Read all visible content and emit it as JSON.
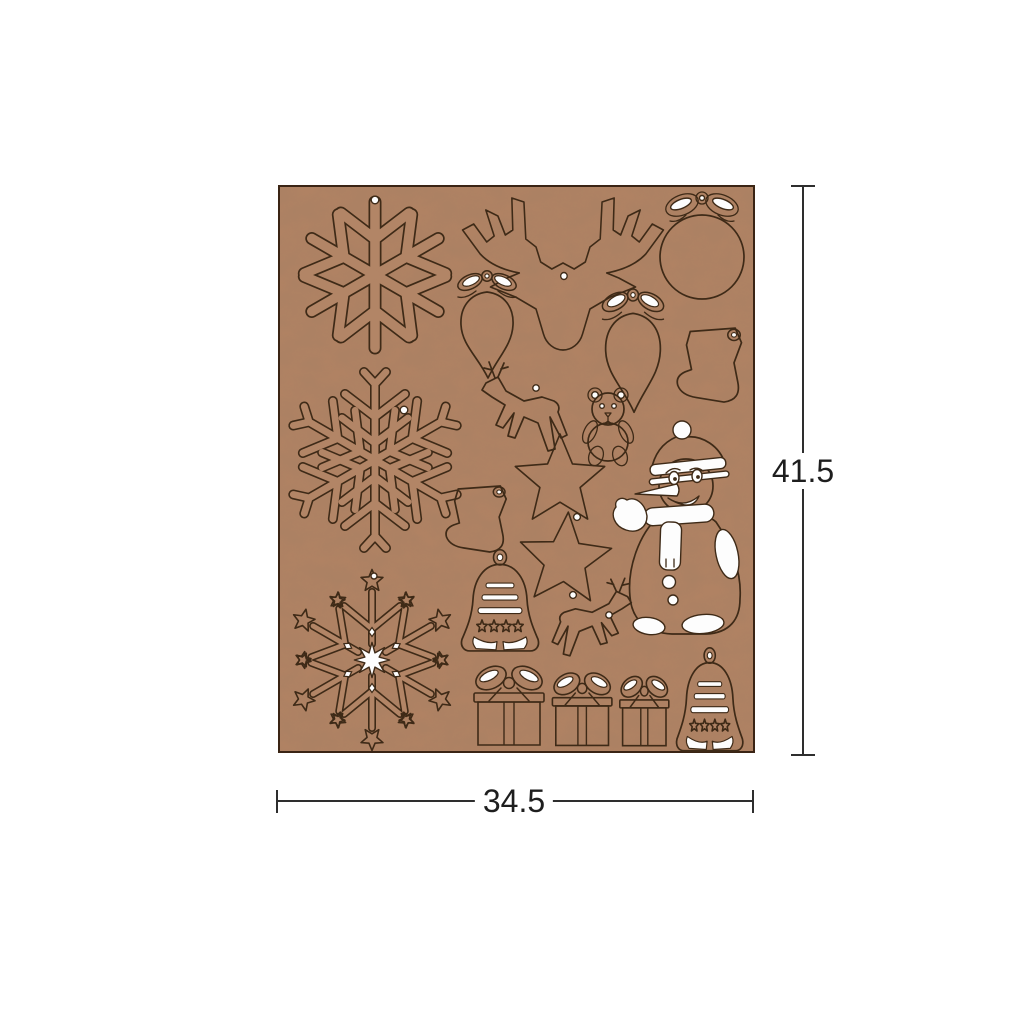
{
  "canvas": {
    "background_color": "#ffffff"
  },
  "sheet": {
    "base_color": "#b08263",
    "engrave_line_color": "#3e2a17",
    "cutout_color": "#fdfdfd",
    "shapes": [
      "snowflake-classic-ornament",
      "deer-head-ornament",
      "bauble-with-bow-ornament",
      "drop-ornament-with-bow-1",
      "drop-ornament-with-bow-2",
      "stocking-ornament-large",
      "snowflake-feathery-ornament",
      "leaping-deer-ornament-left",
      "teddy-bear-ornament",
      "snowman-ornament",
      "five-point-star-ornament-1",
      "five-point-star-ornament-2",
      "stocking-ornament-small",
      "bell-with-stars-ornament-1",
      "snowflake-ornate-star-ornament",
      "leaping-deer-ornament-right",
      "gift-box-large",
      "gift-box-medium",
      "gift-box-small",
      "bell-with-stars-ornament-2"
    ]
  },
  "dims": {
    "height_value": "41.5",
    "width_value": "34.5",
    "line_color": "#2e2e2e"
  }
}
